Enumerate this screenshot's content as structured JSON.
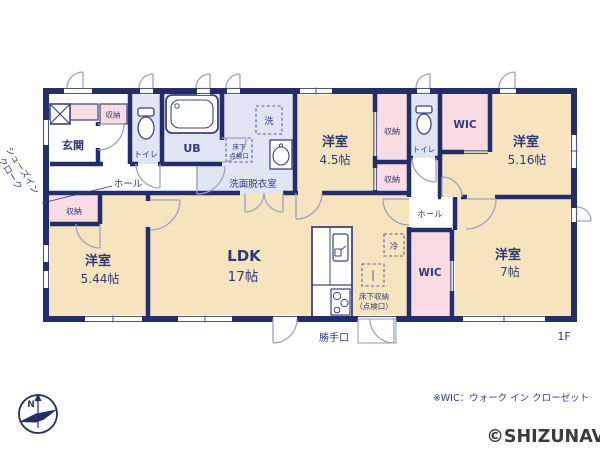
{
  "palette": {
    "wall_navy": "#232d6b",
    "room_cream": "#f6e4bf",
    "closet_pink": "#f9dce3",
    "wet_area_blue": "#dfe5f2",
    "door_arc_gray": "#9aa3c4",
    "label_navy": "#2e3a78",
    "note_blue": "#2f3f8f",
    "watermark_gray": "#3b3b3b"
  },
  "floor_plan": {
    "floor": "1F",
    "rooms": {
      "genkan": {
        "name": "玄関"
      },
      "shoes_in_cloak": {
        "line1": "シューズイン",
        "line2": "クローク"
      },
      "hall_top": {
        "name": "ホール"
      },
      "hall_right": {
        "name": "ホール"
      },
      "toilet_top": {
        "name": "トイレ"
      },
      "toilet_right": {
        "name": "トイレ"
      },
      "ub": {
        "name": "UB"
      },
      "washroom": {
        "name": "洗面脱衣室"
      },
      "room_45": {
        "name": "洋室",
        "size": "4.5帖"
      },
      "room_516": {
        "name": "洋室",
        "size": "5.16帖"
      },
      "room_544": {
        "name": "洋室",
        "size": "5.44帖"
      },
      "room_7": {
        "name": "洋室",
        "size": "7帖"
      },
      "ldk": {
        "name": "LDK",
        "size": "17帖"
      },
      "wic_top": {
        "name": "WIC"
      },
      "wic_bottom": {
        "name": "WIC"
      },
      "closet_genkan": {
        "name": "収納"
      },
      "closet_45_upper": {
        "name": "収納"
      },
      "closet_45_lower": {
        "name": "収納"
      },
      "closet_544": {
        "name": "収納"
      }
    },
    "fixtures": {
      "washer": {
        "label": "洗"
      },
      "fridge": {
        "label": "冷"
      },
      "underfloor_hatch": {
        "line1": "床下",
        "line2": "点検口"
      },
      "underfloor_storage": {
        "line1": "床下収納",
        "line2": "（点検口）"
      },
      "backdoor": {
        "label": "勝手口"
      }
    },
    "compass": {
      "label": "N"
    }
  },
  "footer": {
    "note": "※WIC：ウォーク イン クローゼット",
    "watermark": "©SHIZUNAVI"
  }
}
